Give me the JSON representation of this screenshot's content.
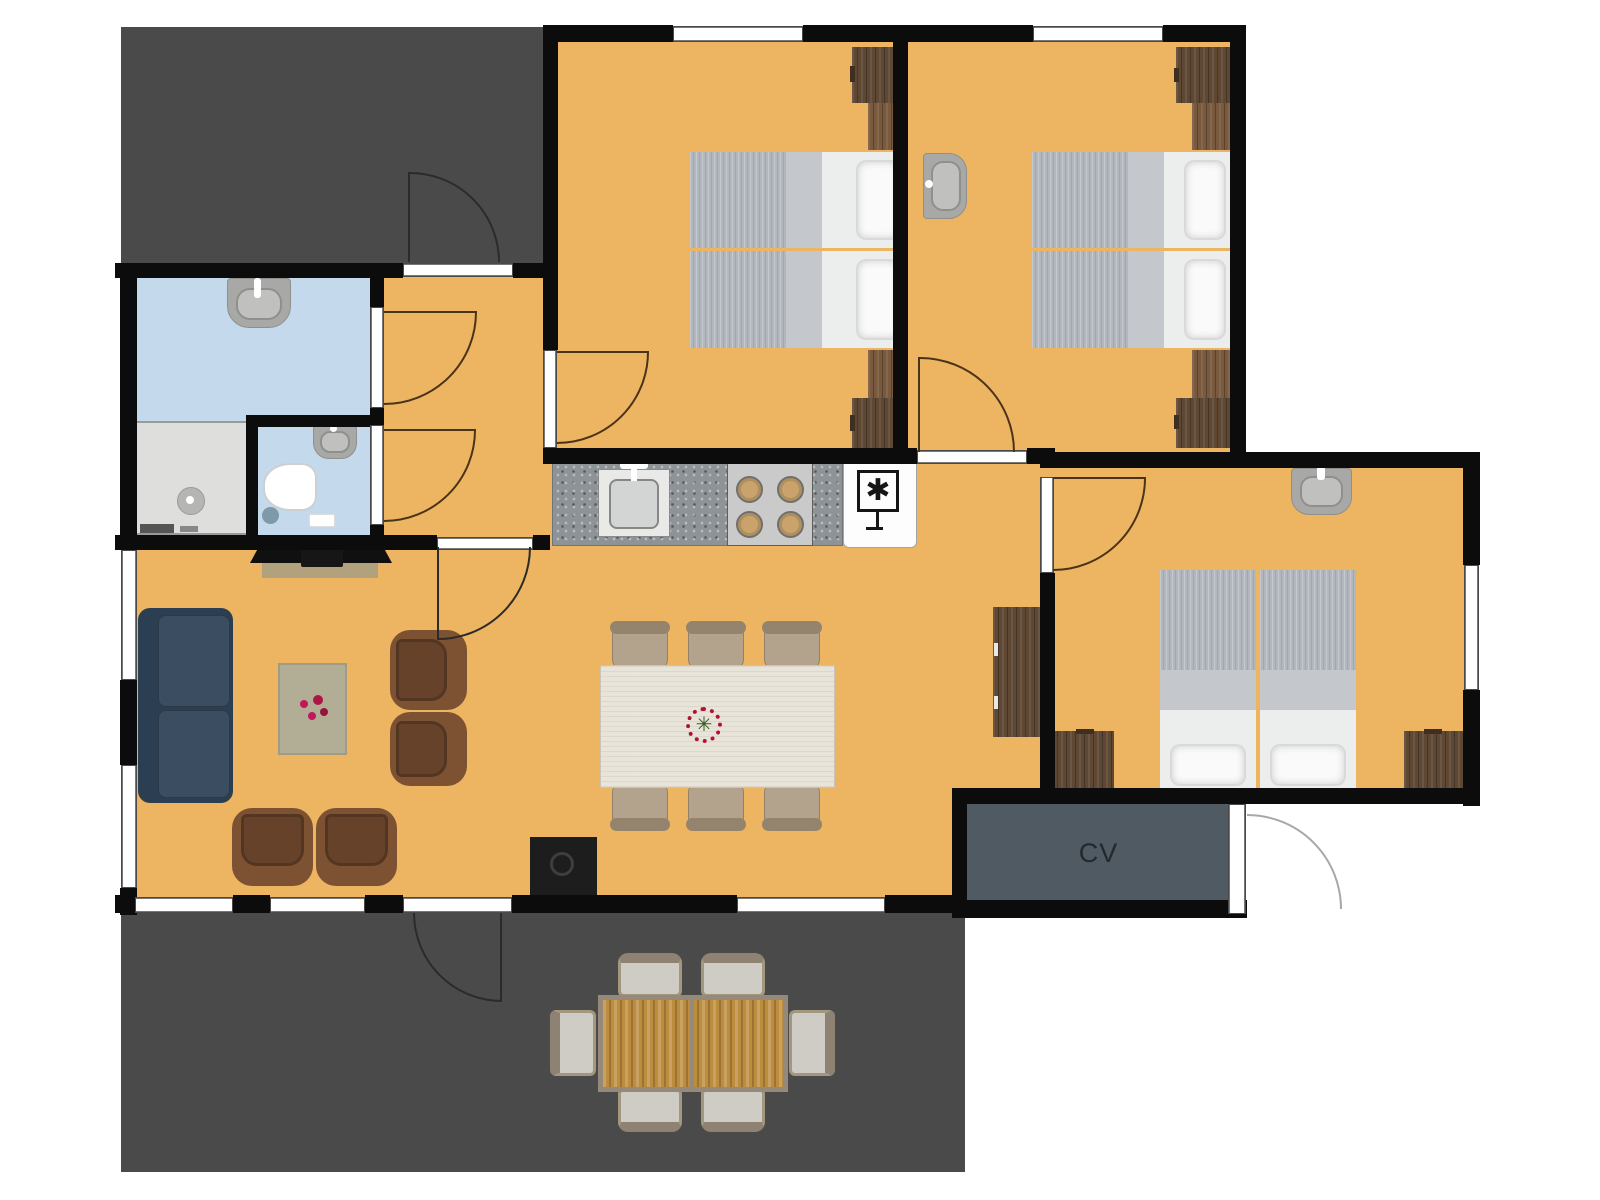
{
  "labels": {
    "cv_room": "CV"
  },
  "glyphs": {
    "fridge_symbol": "✱",
    "centerpiece_flower": "✳"
  },
  "colors": {
    "wall": "#0c0c0c",
    "floor": "#edb562",
    "terrace": "#4a4a4a",
    "bathroom": "#c5d9ed",
    "shower": "#dededc",
    "cv_room": "#4f5a62",
    "cv_text": "#23282c",
    "window_fill": "#ffffff",
    "window_line": "#4a4a4a",
    "counter": "#8d9397",
    "wood_dark": "#5e4834",
    "wood_mid": "#7a5a3e",
    "bed_duvet": "#b2b6bd",
    "bed_fold": "#c4c7cc",
    "bed_base": "#eceded",
    "pillow": "#fafafa",
    "sofa": "#3b4d60",
    "sofa_dark": "#2c3e52",
    "armchair": "#7d5232",
    "armchair_dark": "#66422a",
    "rug": "#b2ad95",
    "table_indoor": "#e9e4da",
    "chair_indoor": "#b3a28c",
    "chair_indoor_dark": "#94846e",
    "outdoor_table": "#bd8d3f",
    "outdoor_frame": "#95897a",
    "outdoor_chair": "#cfccc6",
    "fixture": "#a8a8a6",
    "fixture_light": "#c0c0be",
    "stove": "#c9cac9",
    "arc_wood": "#4a3419",
    "arc_main": "#2b2b2b",
    "arc_light": "#a8a8a8",
    "fireplace": "#1d1d1d"
  }
}
